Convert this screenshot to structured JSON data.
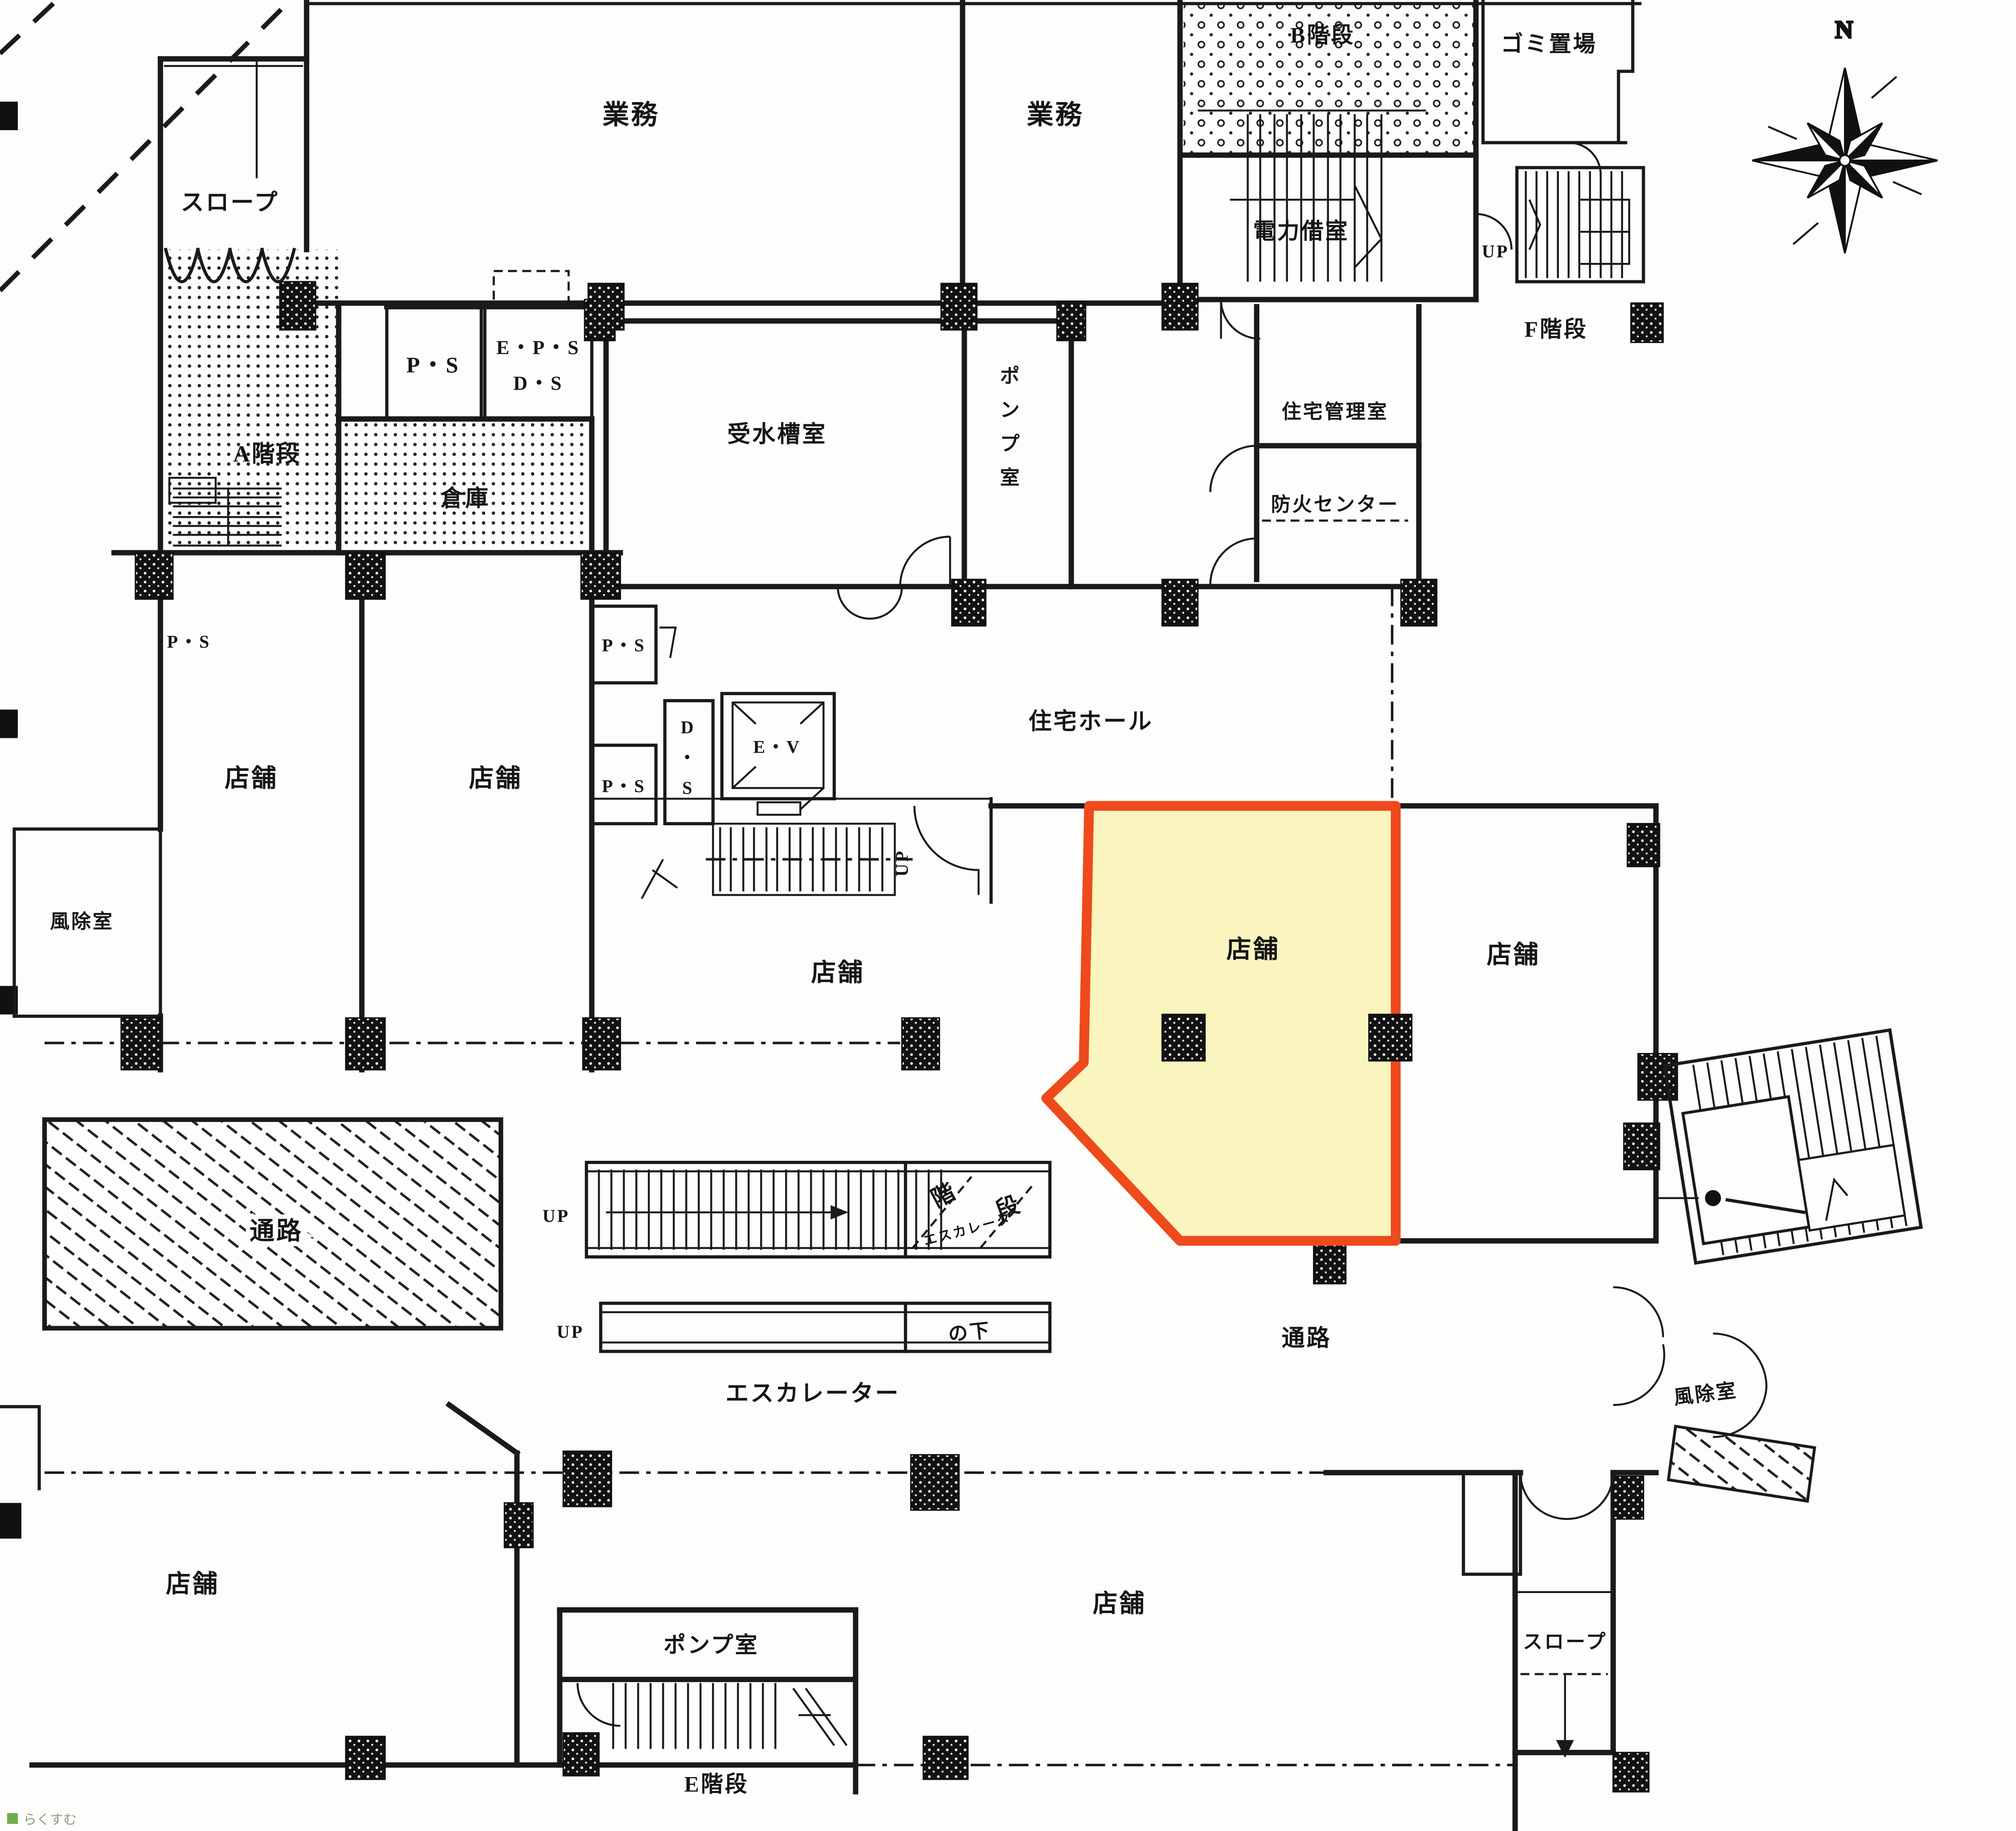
{
  "document": {
    "type": "floor-plan-scan",
    "language": "ja"
  },
  "L": {
    "slope_top": "スロープ",
    "a_stairs": "A階段",
    "ps_service": "P・S",
    "eps": "E・P・S",
    "ds_service": "D・S",
    "souko": "倉庫",
    "gyomu_left": "業務",
    "gyomu_right": "業務",
    "b_stairs": "B階段",
    "gomi_okiba": "ゴミ置場",
    "denryoku": "電力借室",
    "up_f": "UP",
    "f_kaidan": "F階段",
    "jusuiso": "受水槽室",
    "pump_v": [
      "ポ",
      "ン",
      "プ",
      "室"
    ],
    "kanri": "住宅管理室",
    "bouka": "防火センター",
    "ps_left": "P・S",
    "tenpo_l1": "店舗",
    "tenpo_l2": "店舗",
    "fujo_left": "風除室",
    "ps_core_top": "P・S",
    "ds_core": [
      "D",
      "・",
      "S"
    ],
    "ev": "E・V",
    "ps_core_bottom": "P・S",
    "up_core": "UP",
    "hall": "住宅ホール",
    "tenpo_center": "店舗",
    "tenpo_highlight": "店舗",
    "tenpo_right": "店舗",
    "tsuro_left": "通路",
    "tsuro_right": "通路",
    "up_esc1": "UP",
    "up_esc2": "UP",
    "esc": "エスカレーター",
    "hand_kai": "階",
    "hand_dan": "段",
    "hand_esc": "エスカレータ",
    "hand_shita": "の下",
    "fujo_right": "風除室",
    "slope_right": "スロープ",
    "tenpo_bl": "店舗",
    "tenpo_bc": "店舗",
    "pump_b": "ポンプ室",
    "e_kaidan": "E階段",
    "n": "N",
    "watermark": "らくすむ"
  },
  "highlight": {
    "unit_label": "店舗",
    "fill": "#FAF4BE",
    "border": "#EE4A1B"
  },
  "colors": {
    "line": "#1a1a1a",
    "paper": "#fdfdfb",
    "watermark_green": "#6fae4a"
  }
}
